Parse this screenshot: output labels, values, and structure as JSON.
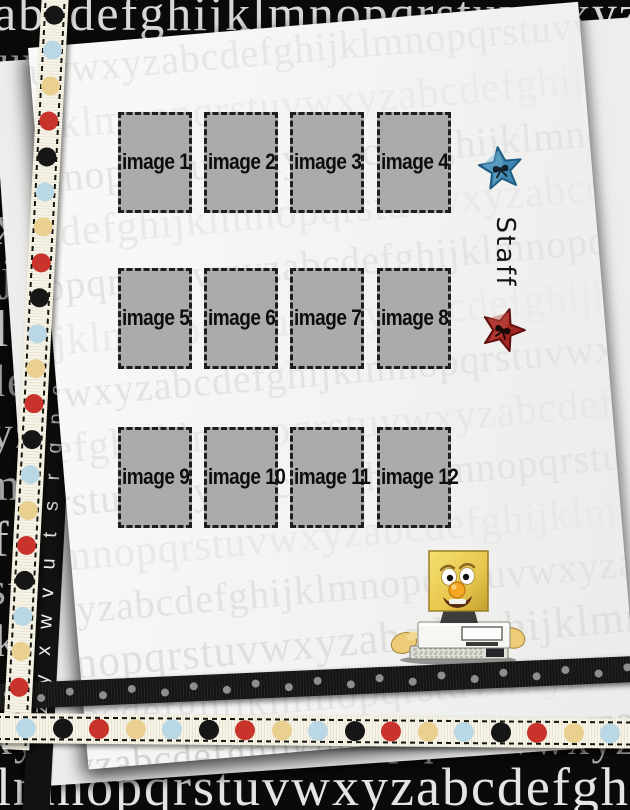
{
  "alphabet": "abcdefghijklmnopqrstuvwxyz",
  "palette": {
    "background": "#0a0a09",
    "paper": "#f4f4f2",
    "under_paper": "#ededeb",
    "box_fill": "#ababab",
    "box_border": "#1e1e1e",
    "ribbon_cream": "#f4f0df",
    "ribbon_black": "#141412"
  },
  "background": {
    "rows": [
      {
        "y": -12,
        "x": -6,
        "size": 50,
        "color": "#d8d8d6",
        "start": 0
      },
      {
        "y": 40,
        "x": -15,
        "size": 44,
        "color": "#999997",
        "start": 19
      },
      {
        "y": 92,
        "x": -10,
        "size": 46,
        "color": "#c6c6c4",
        "start": 13
      },
      {
        "y": 144,
        "x": -20,
        "size": 46,
        "color": "#a6a6a4",
        "start": 1
      },
      {
        "y": 196,
        "x": -8,
        "size": 58,
        "color": "#dcdcda",
        "start": 23
      },
      {
        "y": 252,
        "x": -14,
        "size": 46,
        "color": "#a6a6a4",
        "start": 8
      },
      {
        "y": 304,
        "x": -6,
        "size": 52,
        "color": "#c8c8c6",
        "start": 11
      },
      {
        "y": 358,
        "x": -18,
        "size": 46,
        "color": "#9e9e9c",
        "start": 3
      },
      {
        "y": 410,
        "x": -10,
        "size": 46,
        "color": "#b2b2b0",
        "start": 24
      },
      {
        "y": 462,
        "x": -16,
        "size": 46,
        "color": "#a6a6a4",
        "start": 12
      },
      {
        "y": 514,
        "x": -8,
        "size": 50,
        "color": "#c2c2c0",
        "start": 5
      },
      {
        "y": 566,
        "x": -12,
        "size": 46,
        "color": "#a6a6a4",
        "start": 18
      },
      {
        "y": 618,
        "x": -6,
        "size": 46,
        "color": "#b6b6b4",
        "start": 10
      },
      {
        "y": 668,
        "x": -15,
        "size": 46,
        "color": "#a0a09e",
        "start": 0
      },
      {
        "y": 718,
        "x": -10,
        "size": 44,
        "color": "#aaaaa8",
        "start": 23
      },
      {
        "y": 760,
        "x": -4,
        "size": 54,
        "color": "#e4e4e2",
        "start": 11
      }
    ]
  },
  "paper": {
    "watermark_rows": [
      {
        "y": 4,
        "x": -30,
        "size": 40,
        "color": "#e6e6e4",
        "start": 18
      },
      {
        "y": 58,
        "x": -60,
        "size": 42,
        "color": "#eaeae8",
        "start": 5
      },
      {
        "y": 112,
        "x": -20,
        "size": 40,
        "color": "#e3e3e1",
        "start": 11
      },
      {
        "y": 166,
        "x": -45,
        "size": 42,
        "color": "#e8e8e6",
        "start": 0
      },
      {
        "y": 220,
        "x": -25,
        "size": 40,
        "color": "#e3e3e1",
        "start": 13
      },
      {
        "y": 274,
        "x": -55,
        "size": 42,
        "color": "#eaeae8",
        "start": 6
      },
      {
        "y": 328,
        "x": -15,
        "size": 40,
        "color": "#e3e3e1",
        "start": 21
      },
      {
        "y": 382,
        "x": -50,
        "size": 42,
        "color": "#e7e7e5",
        "start": 2
      },
      {
        "y": 436,
        "x": -30,
        "size": 40,
        "color": "#e2e2e0",
        "start": 16
      },
      {
        "y": 490,
        "x": -60,
        "size": 42,
        "color": "#e8e8e6",
        "start": 9
      },
      {
        "y": 544,
        "x": -20,
        "size": 40,
        "color": "#e2e2e0",
        "start": 23
      },
      {
        "y": 596,
        "x": -40,
        "size": 44,
        "color": "#dfdfdd",
        "start": 12
      },
      {
        "y": 650,
        "x": -25,
        "size": 42,
        "color": "#e4e4e2",
        "start": 0
      },
      {
        "y": 700,
        "x": -35,
        "size": 40,
        "color": "#d2d2d0",
        "start": 23
      }
    ]
  },
  "strip": {
    "letters": "nopqrstuvwxyza",
    "color": "#f0f0ee"
  },
  "grid": {
    "items": [
      {
        "label": "image 1"
      },
      {
        "label": "image 2"
      },
      {
        "label": "image 3"
      },
      {
        "label": "image 4"
      },
      {
        "label": "image 5"
      },
      {
        "label": "image 6"
      },
      {
        "label": "image 7"
      },
      {
        "label": "image 8"
      },
      {
        "label": "image 9"
      },
      {
        "label": "image 10"
      },
      {
        "label": "image 11"
      },
      {
        "label": "image 12"
      }
    ]
  },
  "staff": {
    "label": "Staff"
  },
  "stars": {
    "blue": {
      "fill": "#3f87b0",
      "edge": "#1c5a80",
      "light": "#7ab4d4",
      "bow": "#13202b"
    },
    "red": {
      "fill": "#a32622",
      "edge": "#5e0e0c",
      "light": "#c9564e",
      "bow": "#1c0908"
    }
  },
  "ribbon_vertical": {
    "dot_start": 13,
    "dot_pitch": 35.4,
    "dot_size": 19,
    "cycle": [
      "black",
      "blue",
      "tan",
      "red"
    ],
    "dot_colors": {
      "black": "#161616",
      "blue": "#b9d7e4",
      "tan": "#e9cf90",
      "red": "#c8342c"
    }
  },
  "ribbon_horizontal": {
    "dot_start": 22,
    "dot_pitch": 36.5,
    "dot_size": 20,
    "cycle": [
      "blue",
      "black",
      "red",
      "tan"
    ],
    "dot_colors": {
      "black": "#161616",
      "blue": "#b9d7e4",
      "tan": "#e9cf90",
      "red": "#c8342c"
    }
  },
  "ribbon_black": {
    "dot_start": 10,
    "dot_pitch": 31,
    "dot_size": 8,
    "dot_color": "#8e8e8e"
  }
}
